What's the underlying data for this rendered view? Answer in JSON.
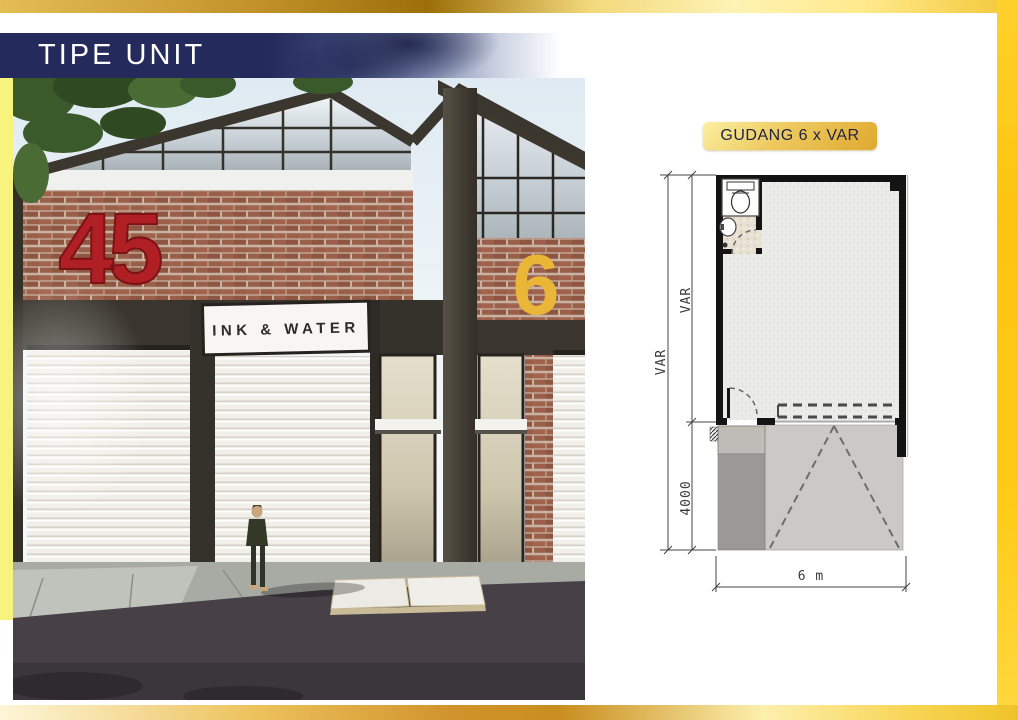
{
  "slide": {
    "header": {
      "title": "TIPE UNIT"
    },
    "rendering": {
      "unit_number_left": "45",
      "unit_number_right": "6",
      "signboard_text": "INK & WATER"
    },
    "floorplan": {
      "title": "GUDANG 6 x VAR",
      "dimensions": {
        "depth_total": "VAR",
        "depth_building": "VAR",
        "front_yard_depth": "4000",
        "width": "6 m"
      },
      "fixtures": [
        "toilet-icon",
        "sink-icon"
      ]
    },
    "colors": {
      "frame_gold": "#E0A93C",
      "banner_navy": "#252A5C",
      "left_accent_yellow": "#F8F37D",
      "unit_number_red": "#B01F24",
      "unit_number_yellow": "#E9B637",
      "plan_wall": "#141414"
    }
  }
}
